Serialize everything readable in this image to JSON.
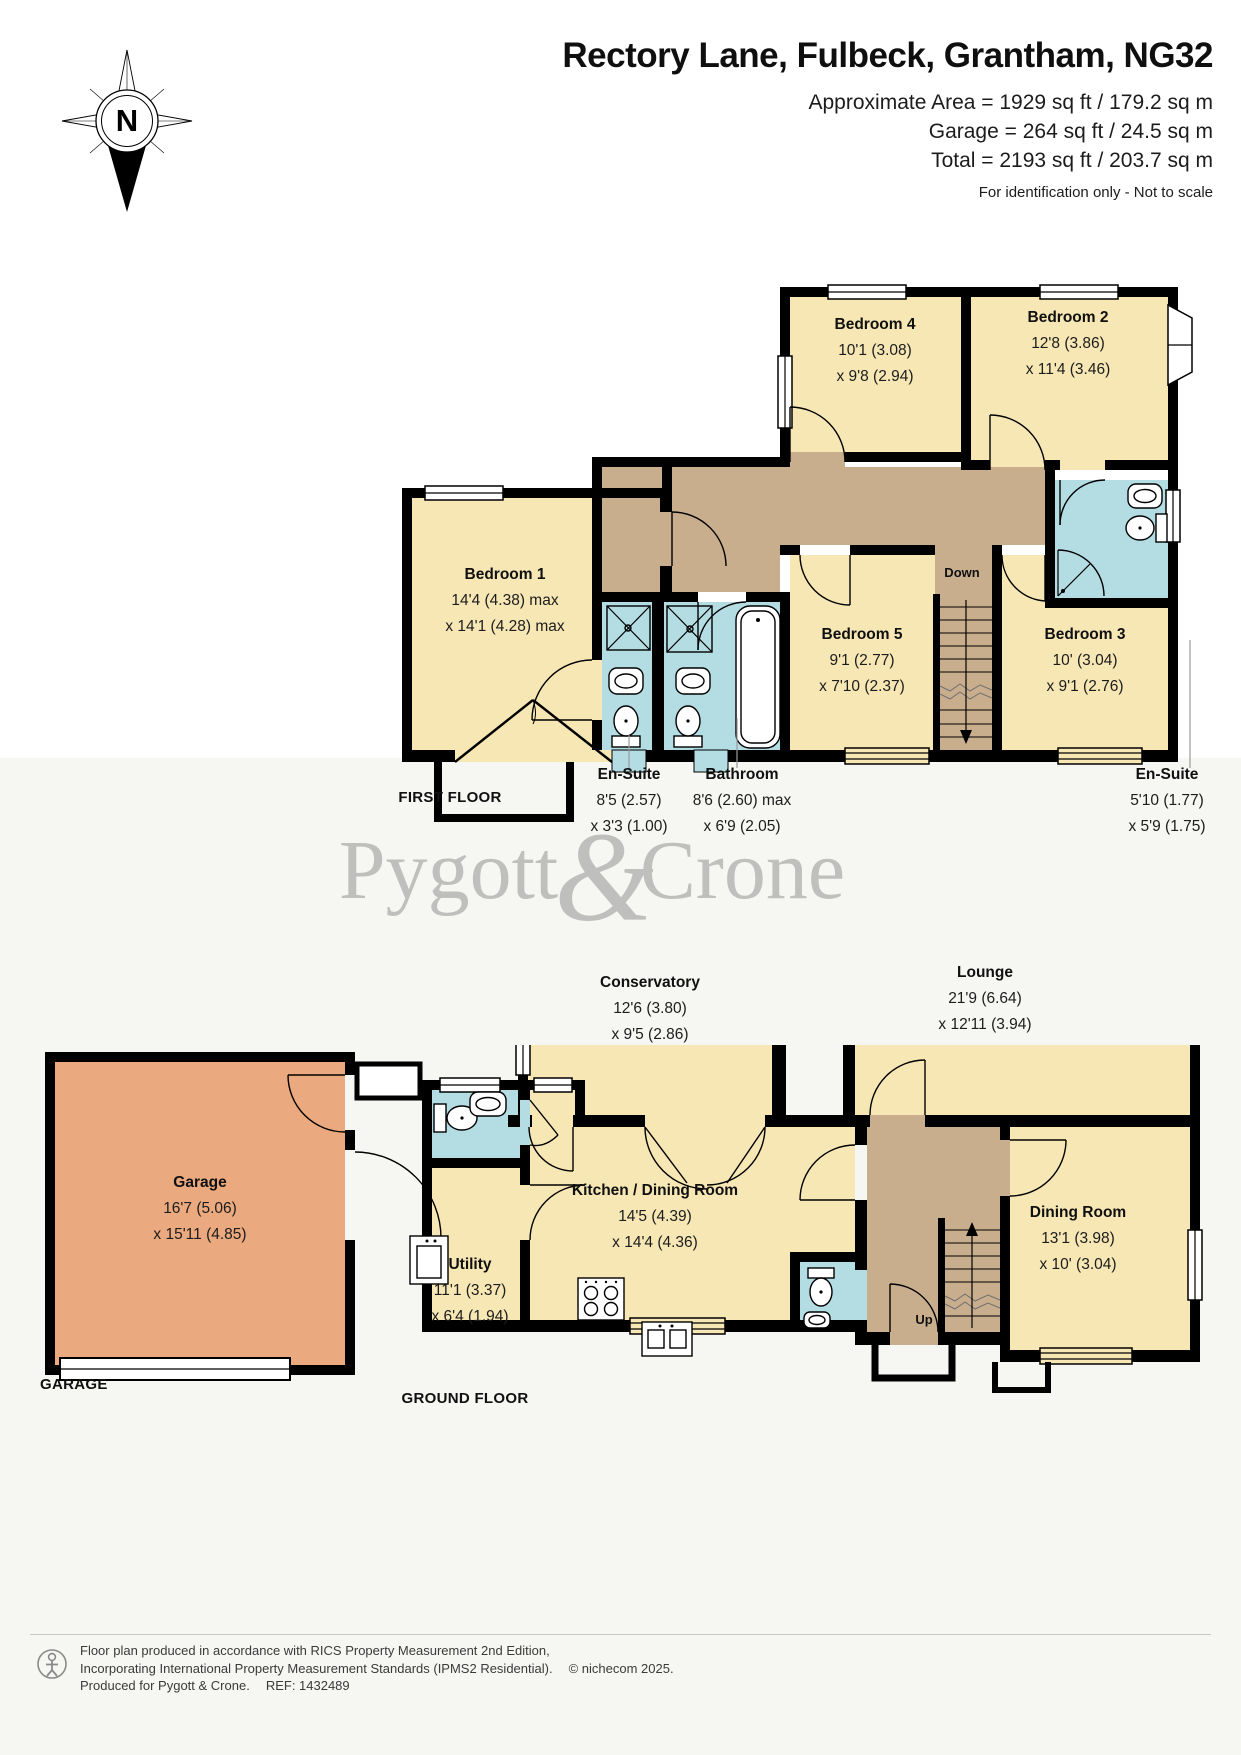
{
  "header": {
    "title": "Rectory Lane, Fulbeck, Grantham, NG32",
    "area_line1": "Approximate Area = 1929 sq ft / 179.2 sq m",
    "area_line2": "Garage = 264 sq ft / 24.5 sq m",
    "area_line3": "Total = 2193 sq ft / 203.7 sq m",
    "disclaimer": "For identification only - Not to scale",
    "compass_label": "N"
  },
  "watermark": {
    "word1": "Pygott",
    "ampersand": "&",
    "word2": "Crone"
  },
  "first_floor": {
    "floor_label": "FIRST FLOOR",
    "stairs_label": "Down",
    "rooms": [
      {
        "name": "Bedroom 4",
        "dim1": "10'1 (3.08)",
        "dim2": "x 9'8 (2.94)"
      },
      {
        "name": "Bedroom 2",
        "dim1": "12'8 (3.86)",
        "dim2": "x 11'4 (3.46)"
      },
      {
        "name": "Bedroom 1",
        "dim1": "14'4 (4.38) max",
        "dim2": "x 14'1 (4.28) max"
      },
      {
        "name": "Bedroom 5",
        "dim1": "9'1 (2.77)",
        "dim2": "x 7'10 (2.37)"
      },
      {
        "name": "Bedroom 3",
        "dim1": "10' (3.04)",
        "dim2": "x 9'1 (2.76)"
      },
      {
        "name": "En-Suite",
        "dim1": "8'5 (2.57)",
        "dim2": "x 3'3 (1.00)"
      },
      {
        "name": "Bathroom",
        "dim1": "8'6 (2.60) max",
        "dim2": "x 6'9 (2.05)"
      },
      {
        "name": "En-Suite",
        "dim1": "5'10 (1.77)",
        "dim2": "x 5'9 (1.75)"
      }
    ]
  },
  "ground_floor": {
    "floor_label": "GROUND FLOOR",
    "garage_block_label": "GARAGE",
    "stairs_label": "Up",
    "rooms": [
      {
        "name": "Conservatory",
        "dim1": "12'6 (3.80)",
        "dim2": "x 9'5 (2.86)"
      },
      {
        "name": "Lounge",
        "dim1": "21'9 (6.64)",
        "dim2": "x 12'11 (3.94)"
      },
      {
        "name": "Kitchen / Dining Room",
        "dim1": "14'5 (4.39)",
        "dim2": "x 14'4 (4.36)"
      },
      {
        "name": "Utility",
        "dim1": "11'1 (3.37)",
        "dim2": "x 6'4 (1.94)"
      },
      {
        "name": "Dining Room",
        "dim1": "13'1 (3.98)",
        "dim2": "x 10' (3.04)"
      },
      {
        "name": "Garage",
        "dim1": "16'7 (5.06)",
        "dim2": "x 15'11 (4.85)"
      }
    ]
  },
  "footer": {
    "line1": "Floor plan produced in accordance with RICS Property Measurement 2nd Edition,",
    "line2": "Incorporating International Property Measurement Standards (IPMS2 Residential).",
    "copyright": "© nichecom 2025.",
    "line3": "Produced for Pygott & Crone.",
    "ref": "REF:  1432489"
  },
  "colors": {
    "room_fill": "#F6E7B5",
    "hall_fill": "#C9AE8E",
    "bath_fill": "#B3DCE3",
    "garage_fill": "#EAA97E",
    "wall": "#000000",
    "watermark_grey": "#8E8E8E"
  }
}
